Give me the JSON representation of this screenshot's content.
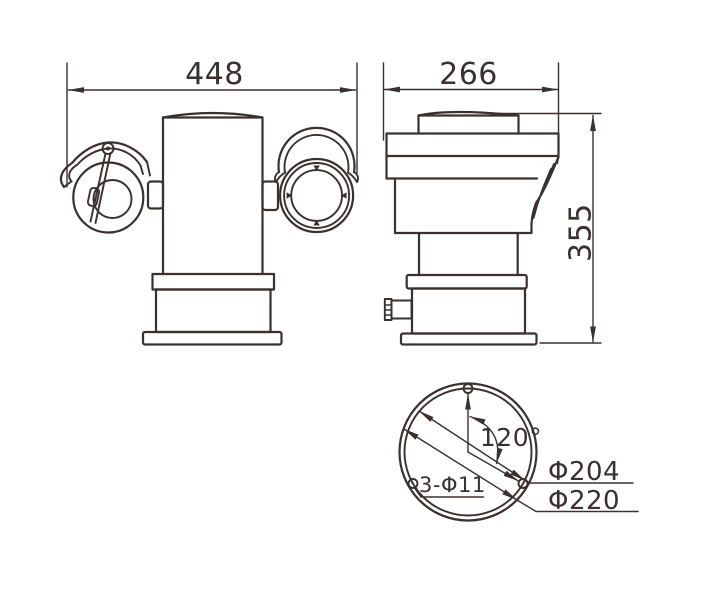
{
  "colors": {
    "line": "#3a312e",
    "background": "#ffffff"
  },
  "drawing": {
    "front_view": {
      "width_dim": "448"
    },
    "side_view": {
      "depth_dim": "266",
      "height_dim": "355"
    },
    "bottom_view": {
      "hole_angle": "120°",
      "mount_holes": "3-Φ11",
      "bolt_circle_dia": "Φ204",
      "base_dia": "Φ220"
    }
  }
}
